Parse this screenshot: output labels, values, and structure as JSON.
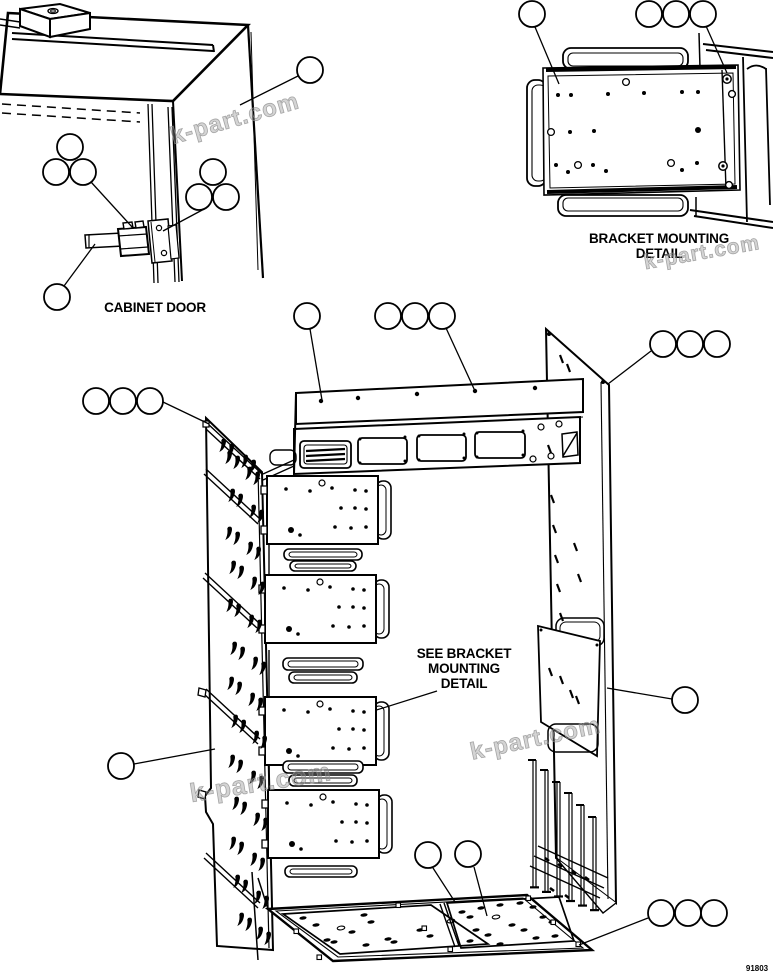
{
  "page": {
    "background": "#ffffff",
    "line_color": "#000000",
    "type": "exploded-parts-diagram"
  },
  "labels": {
    "cabinet_door": "CABINET DOOR",
    "bracket_detail_line1": "BRACKET MOUNTING",
    "bracket_detail_line2": "DETAIL",
    "see_bracket_line1": "SEE BRACKET",
    "see_bracket_line2": "MOUNTING",
    "see_bracket_line3": "DETAIL",
    "drawing_number": "91803"
  },
  "watermark": {
    "text": "k-part.com",
    "color": "#8f8f8f"
  },
  "callouts": {
    "style": "empty-circle",
    "balloon_count": 29,
    "groups": [
      {
        "area": "cabinet-door",
        "balloons": [
          1,
          3,
          3,
          1
        ]
      },
      {
        "area": "bracket-mounting-detail",
        "balloons": [
          1,
          3
        ]
      },
      {
        "area": "cabinet-frame",
        "balloons": [
          1,
          3,
          3,
          3,
          1,
          1,
          1,
          3,
          1
        ]
      }
    ]
  }
}
